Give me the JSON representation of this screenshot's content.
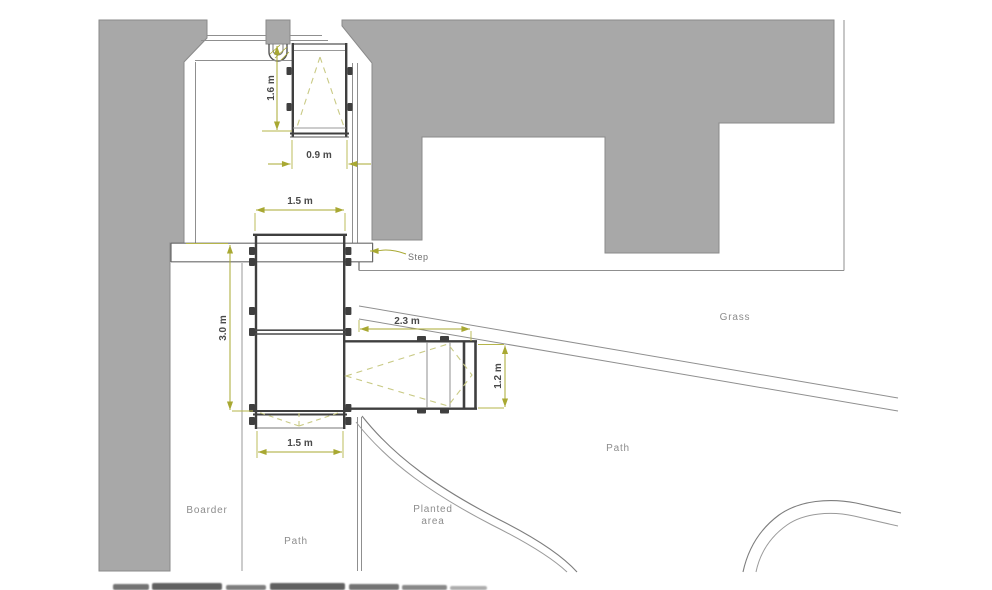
{
  "dimensions": {
    "door_ramp_length": "1.6 m",
    "door_ramp_width": "0.9 m",
    "main_ramp_top_width": "1.5 m",
    "main_ramp_length": "3.0 m",
    "side_ramp_length": "2.3 m",
    "side_ramp_width": "1.2 m",
    "main_ramp_bottom_width": "1.5 m"
  },
  "labels": {
    "step": "Step",
    "grass": "Grass",
    "path_upper": "Path",
    "path_lower": "Path",
    "border": "Boarder",
    "planted_line1": "Planted",
    "planted_line2": "area"
  },
  "colors": {
    "background": "#ffffff",
    "building_fill": "#a8a8a8",
    "building_outline": "#8a8a8a",
    "wall_line_dark": "#3f3f3f",
    "structure_line": "#5a5a5a",
    "thin_line": "#8f8f8f",
    "dimension_line": "#a8a832",
    "extension_line": "#b5b54a",
    "slope_dash": "#c9ca85",
    "dimension_text": "#4a4a4a",
    "label_text": "#8c8c8c"
  }
}
